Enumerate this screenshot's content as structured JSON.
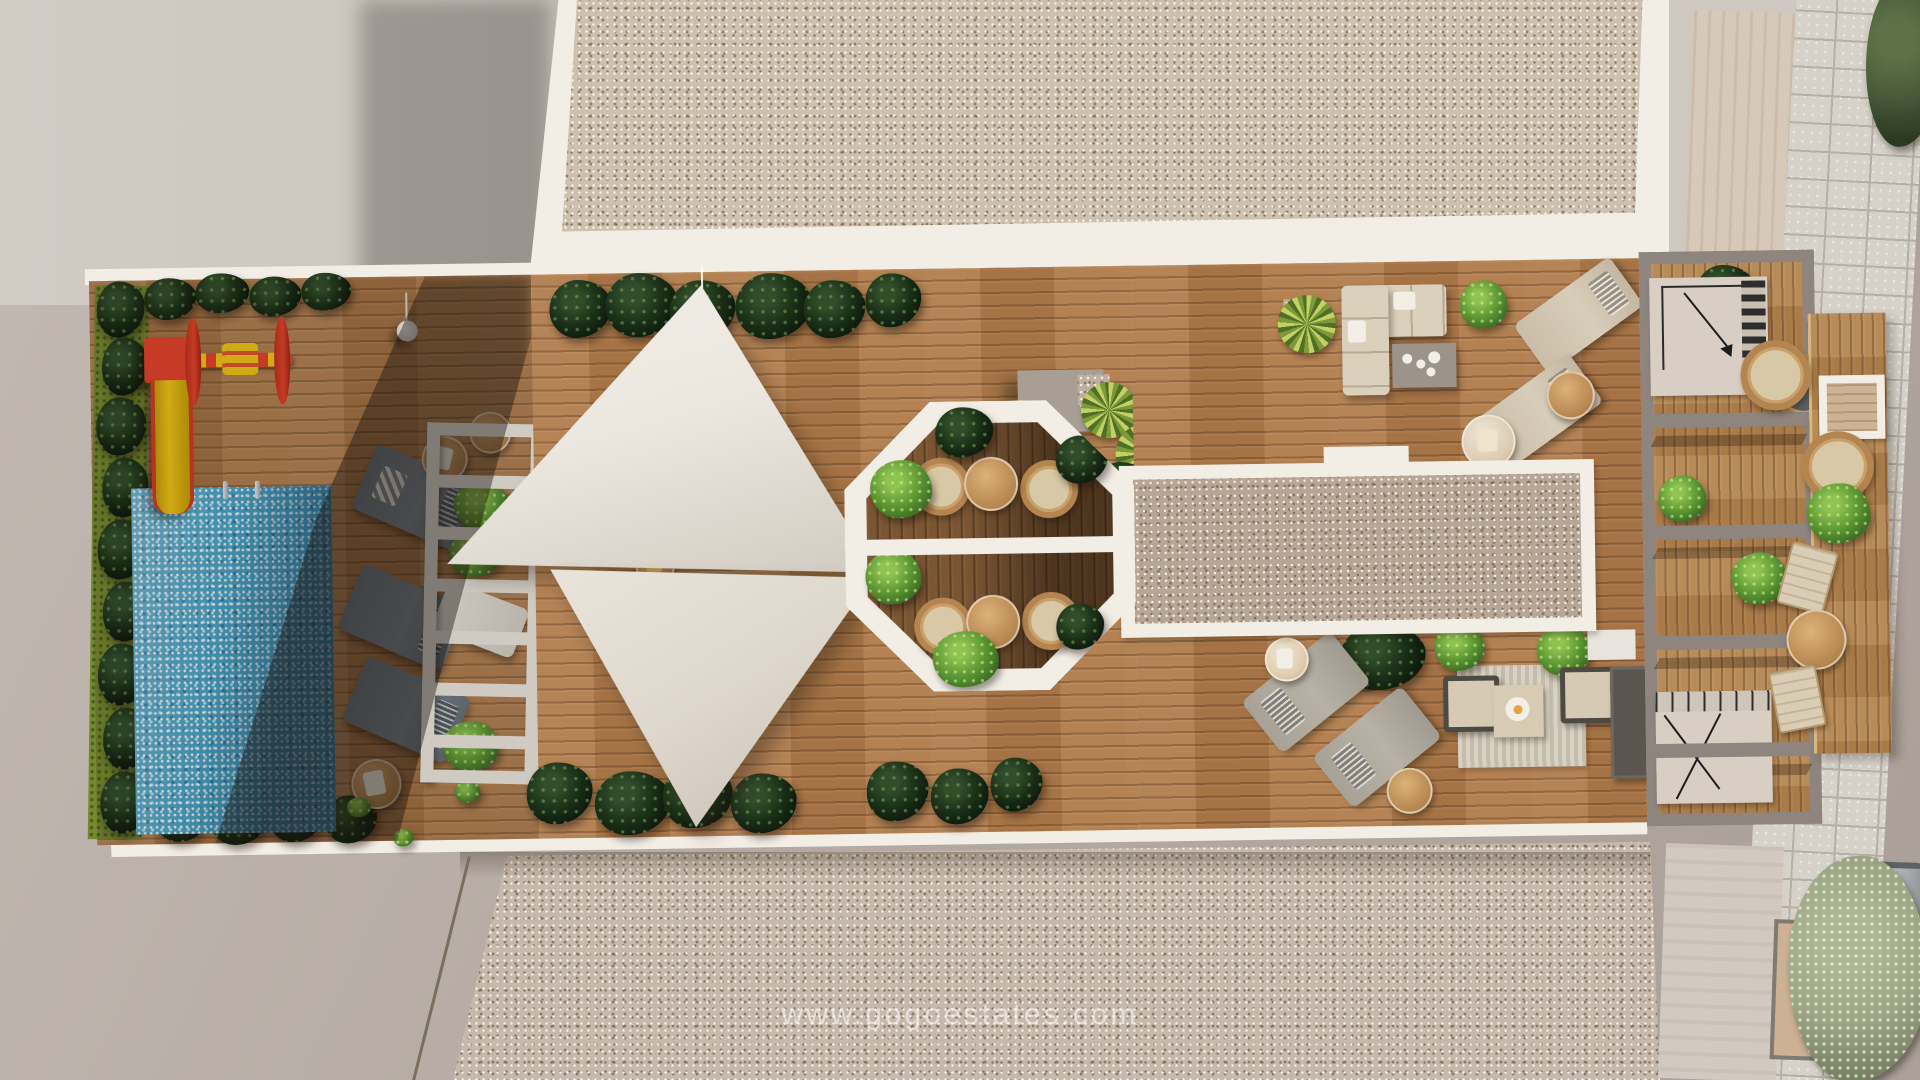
{
  "scene": {
    "type": "aerial-3d-render",
    "description": "Top-down 3D render of a residential rooftop community terrace with children's pool and slide, playground spinner, sun loungers, white slatted pergola, two triangular shade sails, octagonal light-well with bistro seating, gravel roof strips, outdoor sofa and lounge corners, grey beam pergola with stairwells, east balcony with wicker furniture, stone path, trees and a parked car",
    "watermark": "www.gogoestates.com"
  },
  "colors": {
    "wall": "#f2ede5",
    "base": "#b5aba4",
    "concrete": "#cfc8c1",
    "stone": "#d6d1c9",
    "stoneJoint": "#b5afa5",
    "gravelTop": "#cdc0ae",
    "gravelStrip": "#b7a695",
    "gravelBottom": "#c6b9ab",
    "wood": "#b07c4b",
    "woodOct": "#7b5633",
    "pool": "#49a5c9",
    "sail": "#ece8e0",
    "sailLow": "#ded7cc",
    "grass": "#76892f",
    "bushDark": "#16281a",
    "bushBright": "#55912f",
    "yuccaA": "#c3d065",
    "yuccaB": "#7c9a37",
    "slideRed": "#e8432c",
    "slideYellow": "#f5c818",
    "loungerShade": "#7e8993",
    "loungerBeige": "#d8cdb9",
    "loungerLight": "#b8b2a6",
    "rattan": "#b5854f",
    "sofa": "#dbd0bc",
    "pergola": "#8d857e",
    "cube": "#a89e94",
    "tableGrey": "#9c948b",
    "skylight": "#ccb195",
    "treeDark": "#49593a",
    "treePale": "#9aa383",
    "car": "#b7babb"
  }
}
